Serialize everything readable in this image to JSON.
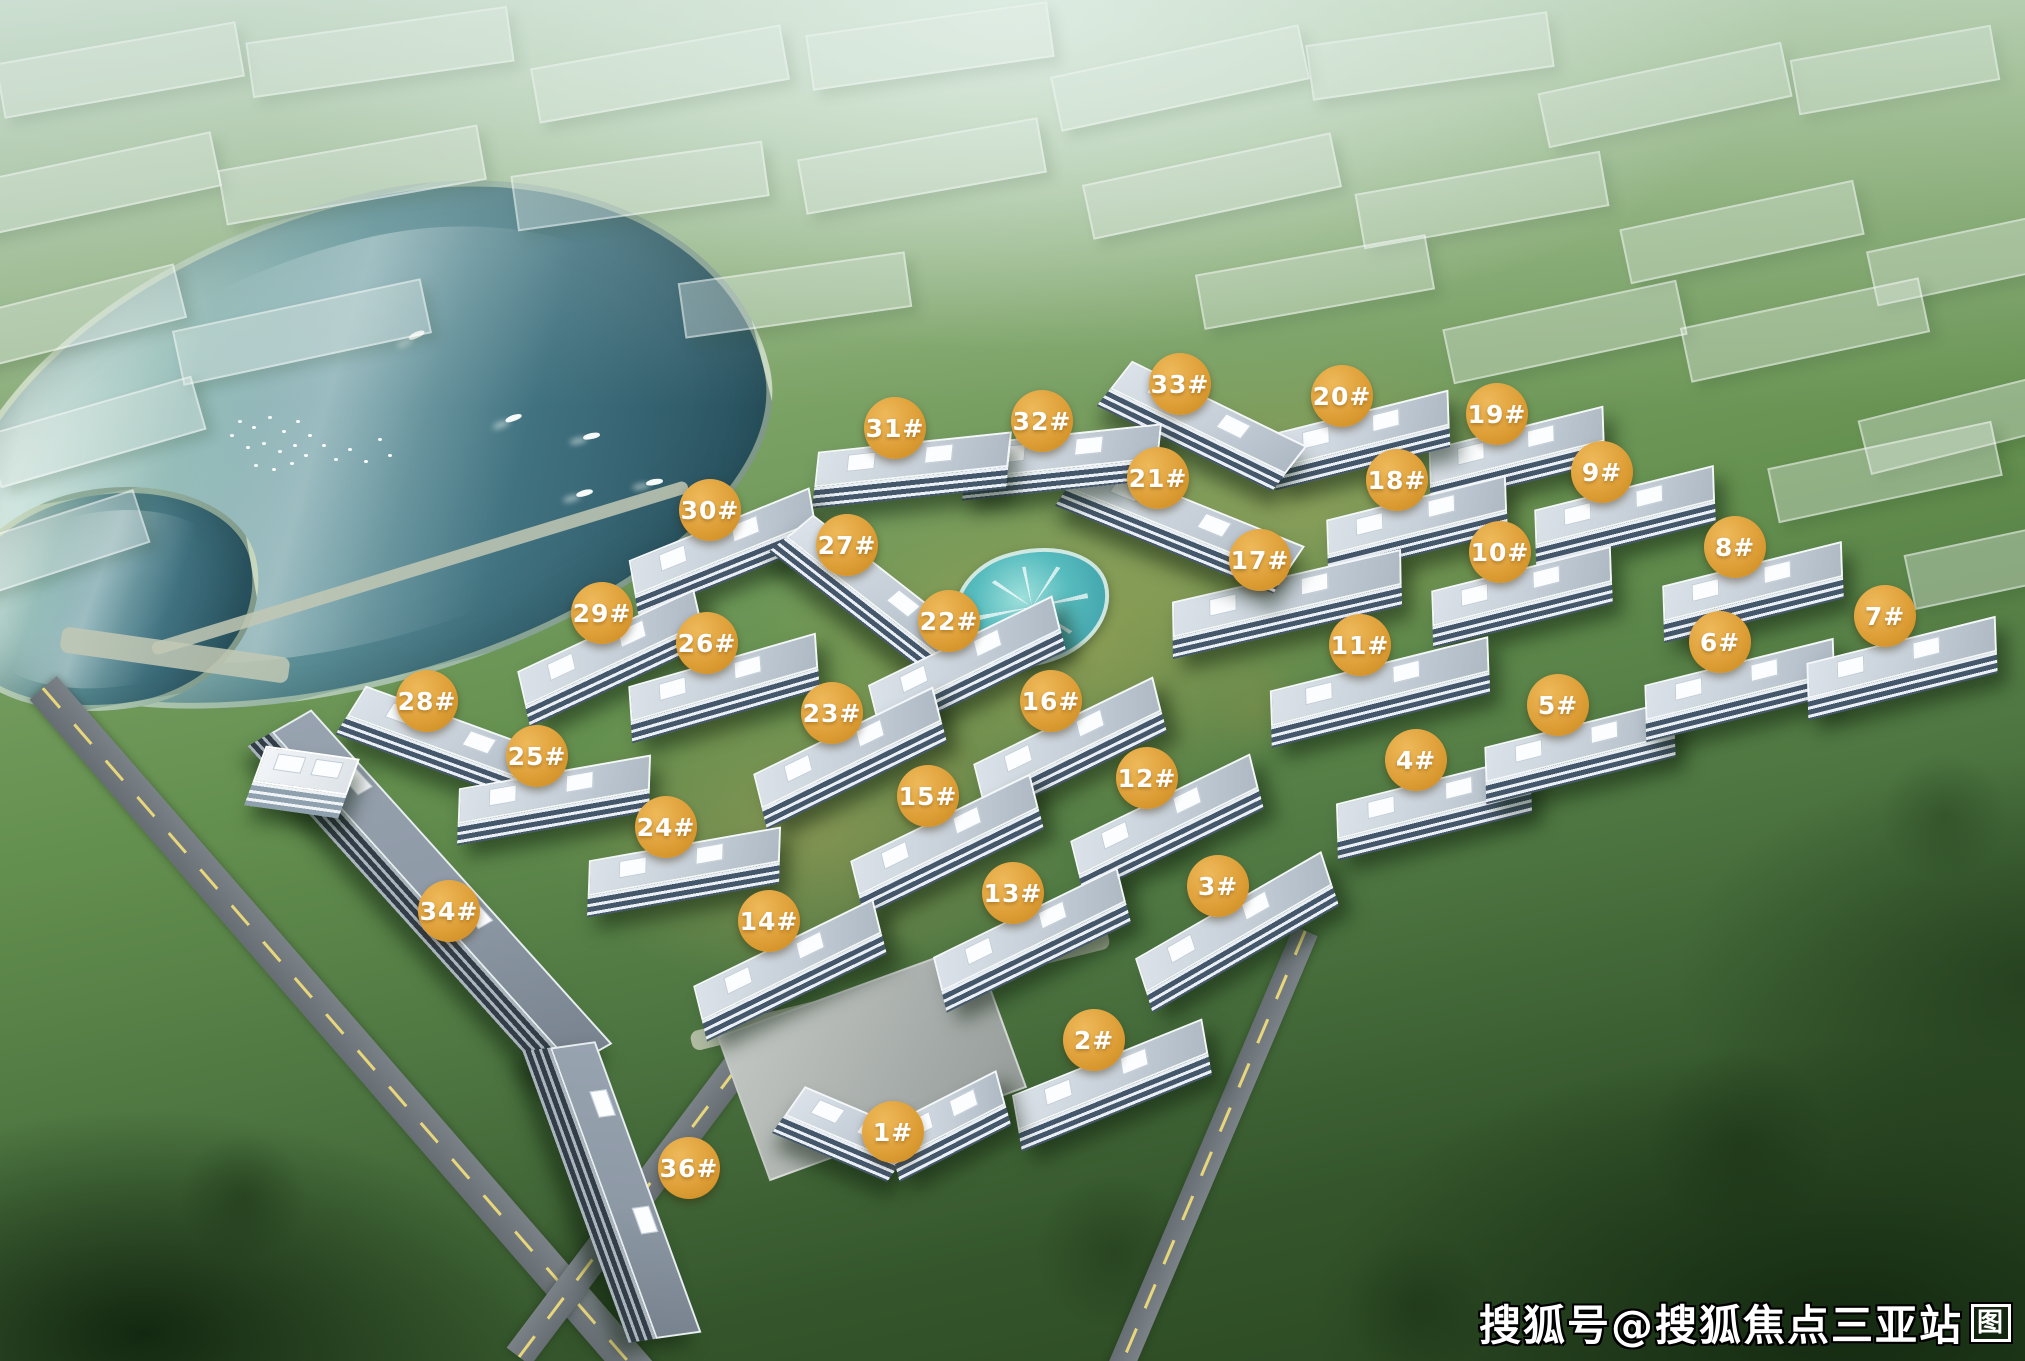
{
  "image": {
    "description": "Aerial bird's-eye rendering of a lakeside residential community master plan with numbered building markers",
    "location_hint": "三亚"
  },
  "watermark": {
    "text": "搜狐号@搜狐焦点三亚站",
    "logo_glyph": "图",
    "text_color": "#ffffff",
    "outline_color": "#000000"
  },
  "markers": {
    "style": {
      "fill": "#dd9d35",
      "fill_highlight": "#eeb95a",
      "fill_shadow": "#c8871f",
      "text_color": "#ffffff"
    },
    "items": [
      {
        "label": "1#",
        "x": 893,
        "y": 1132
      },
      {
        "label": "2#",
        "x": 1094,
        "y": 1040
      },
      {
        "label": "3#",
        "x": 1218,
        "y": 886
      },
      {
        "label": "4#",
        "x": 1416,
        "y": 760
      },
      {
        "label": "5#",
        "x": 1558,
        "y": 705
      },
      {
        "label": "6#",
        "x": 1720,
        "y": 642
      },
      {
        "label": "7#",
        "x": 1885,
        "y": 616
      },
      {
        "label": "8#",
        "x": 1735,
        "y": 547
      },
      {
        "label": "9#",
        "x": 1602,
        "y": 472
      },
      {
        "label": "10#",
        "x": 1500,
        "y": 552
      },
      {
        "label": "11#",
        "x": 1360,
        "y": 645
      },
      {
        "label": "12#",
        "x": 1147,
        "y": 778
      },
      {
        "label": "13#",
        "x": 1013,
        "y": 893
      },
      {
        "label": "14#",
        "x": 769,
        "y": 921
      },
      {
        "label": "15#",
        "x": 928,
        "y": 796
      },
      {
        "label": "16#",
        "x": 1051,
        "y": 701
      },
      {
        "label": "17#",
        "x": 1260,
        "y": 560
      },
      {
        "label": "18#",
        "x": 1397,
        "y": 480
      },
      {
        "label": "19#",
        "x": 1497,
        "y": 414
      },
      {
        "label": "20#",
        "x": 1342,
        "y": 396
      },
      {
        "label": "21#",
        "x": 1158,
        "y": 478
      },
      {
        "label": "22#",
        "x": 949,
        "y": 621
      },
      {
        "label": "23#",
        "x": 832,
        "y": 713
      },
      {
        "label": "24#",
        "x": 666,
        "y": 827
      },
      {
        "label": "25#",
        "x": 537,
        "y": 756
      },
      {
        "label": "26#",
        "x": 707,
        "y": 643
      },
      {
        "label": "27#",
        "x": 847,
        "y": 545
      },
      {
        "label": "28#",
        "x": 427,
        "y": 701
      },
      {
        "label": "29#",
        "x": 602,
        "y": 613
      },
      {
        "label": "30#",
        "x": 710,
        "y": 510
      },
      {
        "label": "31#",
        "x": 895,
        "y": 428
      },
      {
        "label": "32#",
        "x": 1042,
        "y": 421
      },
      {
        "label": "33#",
        "x": 1180,
        "y": 384
      },
      {
        "label": "34#",
        "x": 449,
        "y": 911
      },
      {
        "label": "36#",
        "x": 689,
        "y": 1168
      }
    ]
  },
  "scene": {
    "palette": {
      "forest_dark": "#27441f",
      "forest_mid": "#4c7440",
      "forest_light": "#9cba92",
      "mist": "#dfeee6",
      "golden_palm": "#cdb165",
      "lake_deep": "#27505e",
      "lake_light": "#d5e9e3",
      "shore": "#c4d0a8",
      "roof": "#c6cfd8",
      "roof_edge": "#f4f7fa",
      "facade_dark": "#45576a",
      "strip_roof": "#8e99a6",
      "asphalt": "#6e767b",
      "road_line": "#e8d67a",
      "pool_water": "#57bcbe"
    },
    "lake_blobs": [
      {
        "x": 350,
        "y": 445,
        "w": 840,
        "h": 470,
        "rot": -14,
        "radius": "58% 42% 52% 48% / 62% 55% 45% 38%"
      },
      {
        "x": 105,
        "y": 600,
        "w": 300,
        "h": 210,
        "rot": -10,
        "radius": "50% 50% 45% 55% / 55% 45% 55% 45%"
      }
    ],
    "pool": {
      "x": 1032,
      "y": 607,
      "w": 150,
      "h": 108,
      "rot": -14
    },
    "buildings": [
      {
        "label": "19",
        "x": 1517,
        "y": 456,
        "w": 180,
        "rot": -14
      },
      {
        "label": "20",
        "x": 1362,
        "y": 440,
        "w": 180,
        "rot": -14
      },
      {
        "label": "18",
        "x": 1417,
        "y": 526,
        "w": 185,
        "rot": -14
      },
      {
        "label": "9",
        "x": 1625,
        "y": 516,
        "w": 185,
        "rot": -14
      },
      {
        "label": "10",
        "x": 1522,
        "y": 597,
        "w": 185,
        "rot": -14
      },
      {
        "label": "8",
        "x": 1753,
        "y": 592,
        "w": 185,
        "rot": -14
      },
      {
        "label": "17",
        "x": 1287,
        "y": 604,
        "w": 235,
        "rot": -13
      },
      {
        "label": "21",
        "x": 1180,
        "y": 526,
        "w": 235,
        "rot": 22
      },
      {
        "label": "33",
        "x": 1202,
        "y": 426,
        "w": 195,
        "rot": 26
      },
      {
        "label": "32",
        "x": 1062,
        "y": 462,
        "w": 195,
        "rot": -6
      },
      {
        "label": "31",
        "x": 912,
        "y": 470,
        "w": 195,
        "rot": -6
      },
      {
        "label": "30",
        "x": 724,
        "y": 552,
        "w": 195,
        "rot": -22
      },
      {
        "label": "27",
        "x": 872,
        "y": 596,
        "w": 205,
        "rot": 38
      },
      {
        "label": "29",
        "x": 612,
        "y": 658,
        "w": 195,
        "rot": -25
      },
      {
        "label": "26",
        "x": 724,
        "y": 688,
        "w": 195,
        "rot": -16
      },
      {
        "label": "22",
        "x": 967,
        "y": 668,
        "w": 205,
        "rot": -26
      },
      {
        "label": "28",
        "x": 447,
        "y": 745,
        "w": 205,
        "rot": 20
      },
      {
        "label": "23",
        "x": 850,
        "y": 758,
        "w": 200,
        "rot": -26
      },
      {
        "label": "16",
        "x": 1070,
        "y": 748,
        "w": 200,
        "rot": -26
      },
      {
        "label": "25",
        "x": 554,
        "y": 800,
        "w": 195,
        "rot": -10
      },
      {
        "label": "12",
        "x": 1167,
        "y": 825,
        "w": 200,
        "rot": -26
      },
      {
        "label": "11",
        "x": 1380,
        "y": 692,
        "w": 225,
        "rot": -14
      },
      {
        "label": "4",
        "x": 1434,
        "y": 808,
        "w": 200,
        "rot": -14
      },
      {
        "label": "5",
        "x": 1580,
        "y": 752,
        "w": 195,
        "rot": -14
      },
      {
        "label": "6",
        "x": 1740,
        "y": 690,
        "w": 195,
        "rot": -14
      },
      {
        "label": "7",
        "x": 1902,
        "y": 668,
        "w": 195,
        "rot": -14
      },
      {
        "label": "24",
        "x": 684,
        "y": 872,
        "w": 195,
        "rot": -10
      },
      {
        "label": "15",
        "x": 947,
        "y": 845,
        "w": 200,
        "rot": -26
      },
      {
        "label": "14",
        "x": 790,
        "y": 970,
        "w": 200,
        "rot": -26
      },
      {
        "label": "13",
        "x": 1032,
        "y": 940,
        "w": 205,
        "rot": -26
      },
      {
        "label": "3",
        "x": 1237,
        "y": 932,
        "w": 215,
        "rot": -30
      },
      {
        "label": "2",
        "x": 1112,
        "y": 1085,
        "w": 205,
        "rot": -22
      },
      {
        "label": "1-west",
        "x": 846,
        "y": 1134,
        "w": 125,
        "rot": 23
      },
      {
        "label": "1-east",
        "x": 948,
        "y": 1126,
        "w": 125,
        "rot": -27
      }
    ],
    "strip_buildings": [
      {
        "label": "34-north",
        "x": 430,
        "y": 895,
        "w": 450,
        "h": 72,
        "rot": 48
      },
      {
        "label": "36-south",
        "x": 612,
        "y": 1192,
        "w": 310,
        "h": 72,
        "rot": 70
      }
    ],
    "extra_buildings": [
      {
        "label": "clubhouse",
        "x": 302,
        "y": 782,
        "w": 95,
        "h": 62,
        "rot": 8
      }
    ],
    "ghost_buildings": [
      {
        "x": 120,
        "y": 70,
        "w": 240,
        "rot": -10
      },
      {
        "x": 380,
        "y": 52,
        "w": 260,
        "rot": -8
      },
      {
        "x": 660,
        "y": 74,
        "w": 250,
        "rot": -10
      },
      {
        "x": 930,
        "y": 46,
        "w": 240,
        "rot": -8
      },
      {
        "x": 1180,
        "y": 78,
        "w": 250,
        "rot": -12
      },
      {
        "x": 1430,
        "y": 56,
        "w": 240,
        "rot": -8
      },
      {
        "x": 1665,
        "y": 95,
        "w": 245,
        "rot": -12
      },
      {
        "x": 1895,
        "y": 70,
        "w": 200,
        "rot": -10
      },
      {
        "x": 92,
        "y": 185,
        "w": 250,
        "rot": -12
      },
      {
        "x": 352,
        "y": 175,
        "w": 260,
        "rot": -10
      },
      {
        "x": 640,
        "y": 186,
        "w": 250,
        "rot": -8
      },
      {
        "x": 922,
        "y": 166,
        "w": 240,
        "rot": -10
      },
      {
        "x": 1212,
        "y": 186,
        "w": 250,
        "rot": -12
      },
      {
        "x": 1482,
        "y": 200,
        "w": 245,
        "rot": -10
      },
      {
        "x": 1742,
        "y": 232,
        "w": 235,
        "rot": -12
      },
      {
        "x": 1952,
        "y": 262,
        "w": 160,
        "rot": -12
      },
      {
        "x": 62,
        "y": 320,
        "w": 240,
        "rot": -14
      },
      {
        "x": 302,
        "y": 332,
        "w": 250,
        "rot": -12
      },
      {
        "x": 96,
        "y": 432,
        "w": 210,
        "rot": -16
      },
      {
        "x": 52,
        "y": 545,
        "w": 185,
        "rot": -18
      },
      {
        "x": 1565,
        "y": 332,
        "w": 235,
        "rot": -12
      },
      {
        "x": 1805,
        "y": 330,
        "w": 240,
        "rot": -12
      },
      {
        "x": 1956,
        "y": 425,
        "w": 185,
        "rot": -14
      },
      {
        "x": 1885,
        "y": 472,
        "w": 225,
        "rot": -12
      },
      {
        "x": 1992,
        "y": 565,
        "w": 165,
        "rot": -12
      },
      {
        "x": 795,
        "y": 295,
        "w": 225,
        "rot": -8
      },
      {
        "x": 1315,
        "y": 282,
        "w": 230,
        "rot": -10
      }
    ],
    "roads": [
      {
        "x": 345,
        "y": 1035,
        "len": 920,
        "th": 36,
        "rot": 49,
        "dash": true
      },
      {
        "x": 648,
        "y": 1185,
        "len": 430,
        "th": 30,
        "rot": -53,
        "dash": true
      },
      {
        "x": 1212,
        "y": 1152,
        "len": 480,
        "th": 26,
        "rot": 113,
        "dash": true
      }
    ],
    "paths": [
      {
        "x": 900,
        "y": 990,
        "len": 430,
        "th": 20,
        "rot": -14
      },
      {
        "x": 420,
        "y": 568,
        "len": 560,
        "th": 13,
        "rot": -17
      },
      {
        "x": 175,
        "y": 655,
        "len": 230,
        "th": 26,
        "rot": 8
      }
    ],
    "plaza": {
      "x": 872,
      "y": 1062,
      "w": 270,
      "h": 150,
      "rot": -20
    },
    "boats": [
      {
        "x": 505,
        "y": 415,
        "rot": -20
      },
      {
        "x": 576,
        "y": 490,
        "rot": -15
      },
      {
        "x": 646,
        "y": 479,
        "rot": -10
      },
      {
        "x": 408,
        "y": 332,
        "rot": -25
      },
      {
        "x": 583,
        "y": 433,
        "rot": -12
      }
    ],
    "bird_flock": {
      "x": 238,
      "y": 420
    }
  }
}
